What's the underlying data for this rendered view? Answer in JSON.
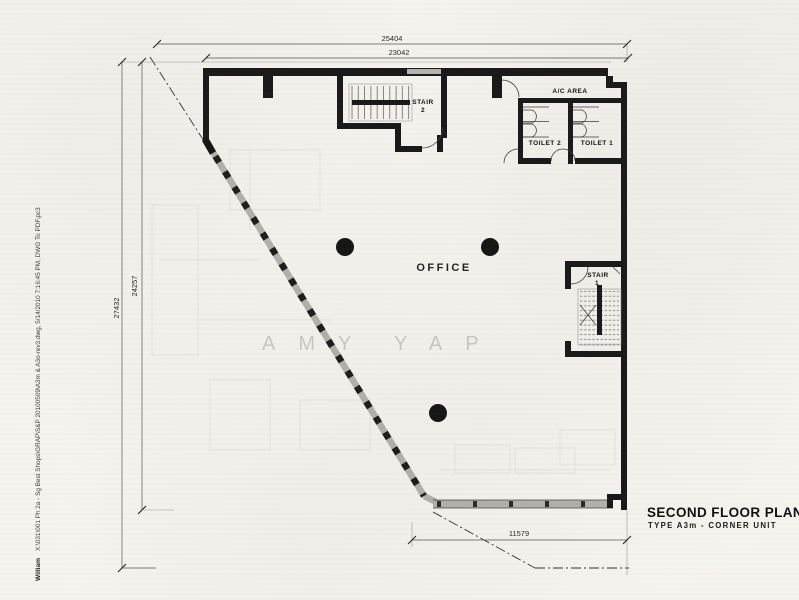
{
  "drawing": {
    "title": "SECOND FLOOR PLAN",
    "subtitle": "TYPE A3m - CORNER UNIT"
  },
  "dimensions_mm": {
    "top_outer": "25404",
    "top_inner": "23042",
    "left_outer": "27432",
    "left_inner": "24257",
    "bottom": "11579"
  },
  "labels": {
    "office": "OFFICE",
    "stair_2_name": "STAIR",
    "stair_2_number": "2",
    "stair_1_name": "STAIR",
    "stair_1_number": "1",
    "ac_area": "A/C AREA",
    "toilet_2": "TOILET 2",
    "toilet_1": "TOILET 1"
  },
  "watermark": {
    "first": "AMY",
    "last": "YAP"
  },
  "plot_stamp": {
    "author": "William",
    "file_info": "X:\\031\\001 Ph 2a - Sg Best Shops\\GRAP\\S&P 20100509\\A3m & A3o-rev3.dwg, 5/14/2010 7:16:45 PM, DWG To PDF.pc3"
  },
  "colors": {
    "ink": "#1b1b1b",
    "paper": "#f5f4ef",
    "hatched_wall": "#b3b2ac",
    "watermark": "#cbcac5"
  }
}
